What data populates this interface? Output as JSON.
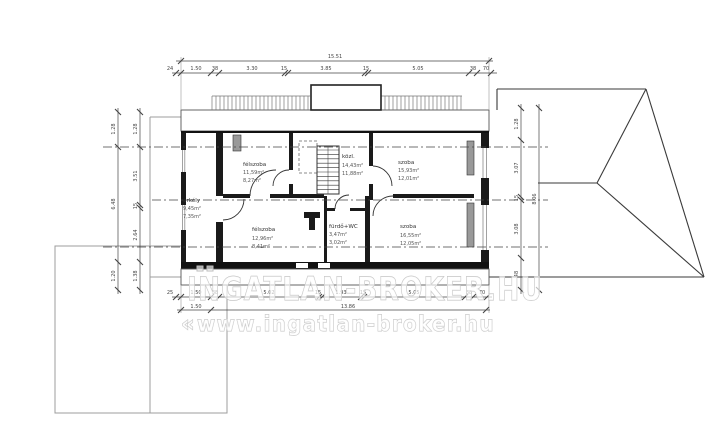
{
  "watermark": {
    "line1": "INGATLAN-BROKER.HU",
    "line2": "www.ingatlan-broker.hu",
    "chevrons": "«"
  },
  "plan": {
    "rooms": [
      {
        "name": "félszoba",
        "area1": "11,59m²",
        "area2": "8,27m²"
      },
      {
        "name": "közl.",
        "area1": "14,43m²",
        "area2": "11,88m²"
      },
      {
        "name": "szoba",
        "area1": "15,93m²",
        "area2": "12,01m²"
      },
      {
        "name": "erkély",
        "area1": "9,45m²",
        "area2": "7,35m²"
      },
      {
        "name": "félszoba",
        "area1": "12,96m²",
        "area2": "8,41m²"
      },
      {
        "name": "fürdő+WC",
        "area1": "3,47m²",
        "area2": "3,02m²"
      },
      {
        "name": "szoba",
        "area1": "16,55m²",
        "area2": "12,05m²"
      }
    ],
    "dims": {
      "top_total": [
        "15.51"
      ],
      "top_chain": [
        "24",
        "1.50",
        "38",
        "3.30",
        "15",
        "3.85",
        "15",
        "5.05",
        "38",
        "70"
      ],
      "bottom_chain": [
        "25",
        "1.50",
        "38",
        "5.02",
        "15",
        "1.93",
        "15",
        "5.05",
        "38",
        "70"
      ],
      "bottom_sub": [
        "1.50",
        "13.86"
      ],
      "left_outer": [
        "1.28",
        "6.48",
        "1.20"
      ],
      "left_inner": [
        "1.28",
        "3.51",
        "15",
        "2.64",
        "1.38"
      ],
      "right_inner": [
        "1.28",
        "3.07",
        "15",
        "3.08",
        "48"
      ],
      "right_outer": [
        "8.06"
      ]
    }
  }
}
